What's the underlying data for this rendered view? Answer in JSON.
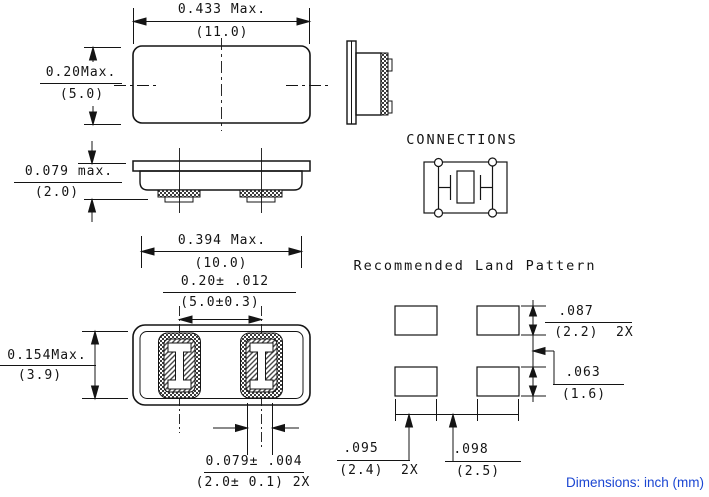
{
  "titles": {
    "connections": "CONNECTIONS",
    "land_pattern": "Recommended Land Pattern"
  },
  "footer": {
    "note": "Dimensions: inch (mm)",
    "color": "#1b46d2"
  },
  "dims": {
    "top_width": {
      "inch": "0.433 Max.",
      "mm": "(11.0)"
    },
    "top_height": {
      "inch": "0.20Max.",
      "mm": "(5.0)"
    },
    "side_height": {
      "inch": "0.079 max.",
      "mm": "(2.0)"
    },
    "bottom_width": {
      "inch": "0.394 Max.",
      "mm": "(10.0)"
    },
    "pad_pitch": {
      "inch": "0.20± .012",
      "mm": "(5.0±0.3)"
    },
    "bottom_height": {
      "inch": "0.154Max.",
      "mm": "(3.9)"
    },
    "pad_width": {
      "inch": "0.079± .004",
      "mm": "(2.0± 0.1) 2X"
    },
    "land_pad_height": {
      "inch": ".087",
      "mm": "(2.2)  2X"
    },
    "land_row_gap": {
      "inch": ".063",
      "mm": "(1.6)"
    },
    "land_pad_width": {
      "inch": ".095",
      "mm": "(2.4)  2X"
    },
    "land_col_gap": {
      "inch": ".098",
      "mm": "(2.5)"
    }
  }
}
